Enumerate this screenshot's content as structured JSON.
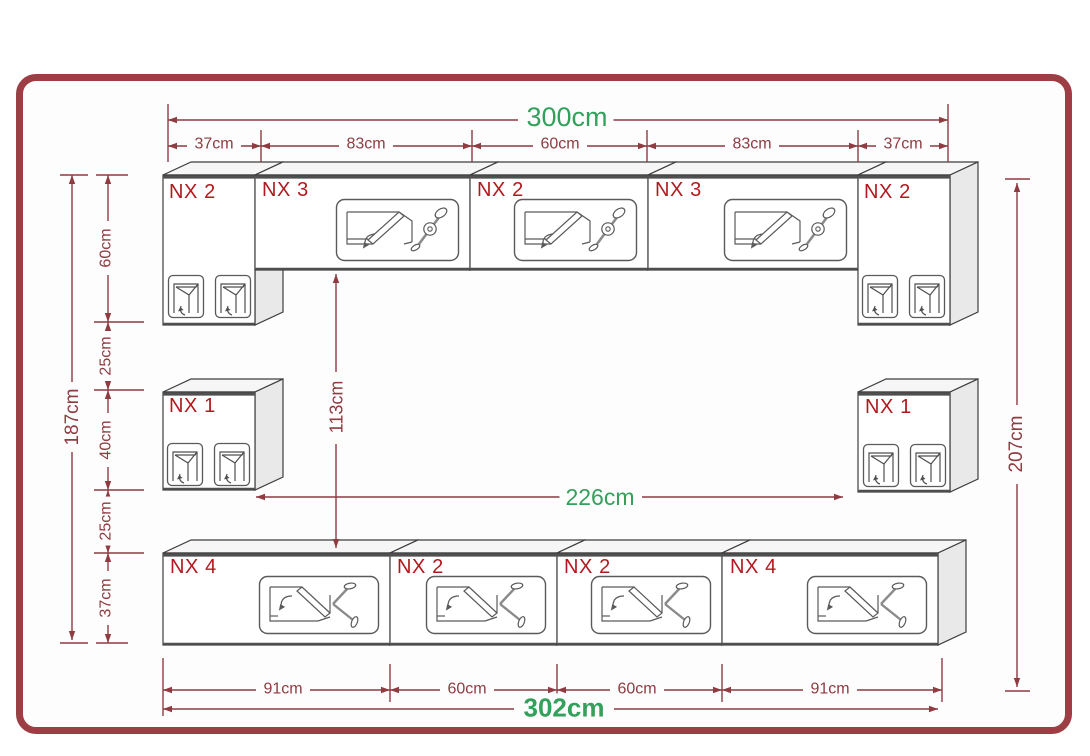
{
  "colors": {
    "frame_border": "#9d3d44",
    "dimension_red": "#8e3b41",
    "cabinet_label_red": "#b2191e",
    "highlight_green": "#33a05c",
    "cabinet_line": "#3e3e3e"
  },
  "dimensions": {
    "top_total": "300cm",
    "top_segments": [
      "37cm",
      "83cm",
      "60cm",
      "83cm",
      "37cm"
    ],
    "left_total": "187cm",
    "left_segments": [
      "60cm",
      "25cm",
      "40cm",
      "25cm",
      "37cm"
    ],
    "inner_height": "113cm",
    "inner_width": "226cm",
    "right_total": "207cm",
    "bottom_segments": [
      "91cm",
      "60cm",
      "60cm",
      "91cm"
    ],
    "bottom_total": "302cm"
  },
  "cabinets": {
    "top_row": [
      {
        "label": "NX 2"
      },
      {
        "label": "NX 3"
      },
      {
        "label": "NX 2"
      },
      {
        "label": "NX 3"
      },
      {
        "label": "NX 2"
      }
    ],
    "middle_row": [
      {
        "label": "NX 1"
      },
      {
        "label": "NX 1"
      }
    ],
    "bottom_row": [
      {
        "label": "NX 4"
      },
      {
        "label": "NX 2"
      },
      {
        "label": "NX 2"
      },
      {
        "label": "NX 4"
      }
    ]
  },
  "icons": {
    "flap_door": "flap-door-mechanism-icon",
    "drop_door": "drop-door-mechanism-icon",
    "hinged_door": "hinged-door-icon"
  }
}
